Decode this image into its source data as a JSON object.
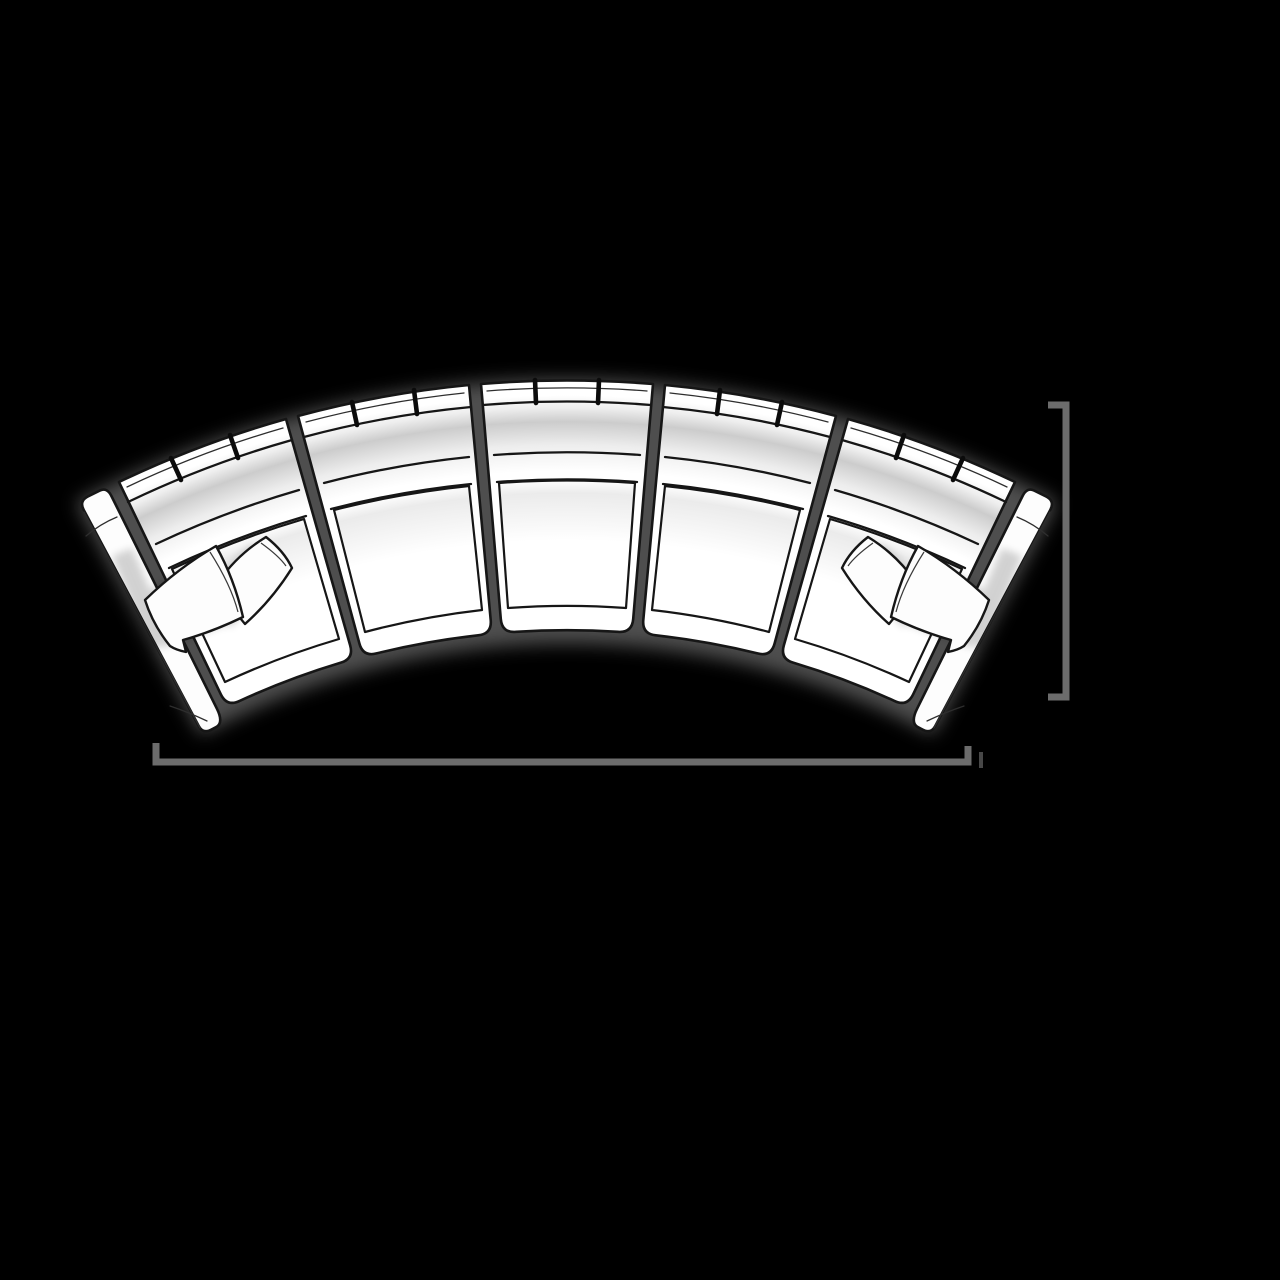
{
  "meta": {
    "description": "Top-down sketch rendering of a curved five-section modular sofa with unlabeled dimension brackets",
    "view": "top"
  },
  "theme": {
    "background": "#000000",
    "ink": "#161616",
    "paper": "#ffffff",
    "dimension_color": "#6c6c6c",
    "shade_gray": "#cccccc",
    "shadow_gray": "#8f8f8f"
  },
  "sofa": {
    "type": "curved-sectional",
    "section_count": 5,
    "armrest_count": 2,
    "pillow_count": 4,
    "back_ticks_per_section": 2,
    "sections": [
      {
        "id": "armrest-left",
        "kind": "armrest"
      },
      {
        "id": "seat-left-arm",
        "kind": "seat",
        "pillows": 2
      },
      {
        "id": "seat-left-mid",
        "kind": "seat",
        "pillows": 0
      },
      {
        "id": "seat-center",
        "kind": "seat",
        "pillows": 0
      },
      {
        "id": "seat-right-mid",
        "kind": "seat",
        "pillows": 0
      },
      {
        "id": "seat-right-arm",
        "kind": "seat",
        "pillows": 2
      },
      {
        "id": "armrest-right",
        "kind": "armrest"
      }
    ]
  },
  "dimension_markers": {
    "labels_visible": false,
    "right_bracket": {
      "orientation": "vertical",
      "x": 1066,
      "y_start": 405,
      "y_end": 697,
      "tick_length": 18
    },
    "bottom_bracket": {
      "orientation": "horizontal",
      "y": 762,
      "x_start": 156,
      "x_end": 968,
      "tick_length": 18
    }
  }
}
